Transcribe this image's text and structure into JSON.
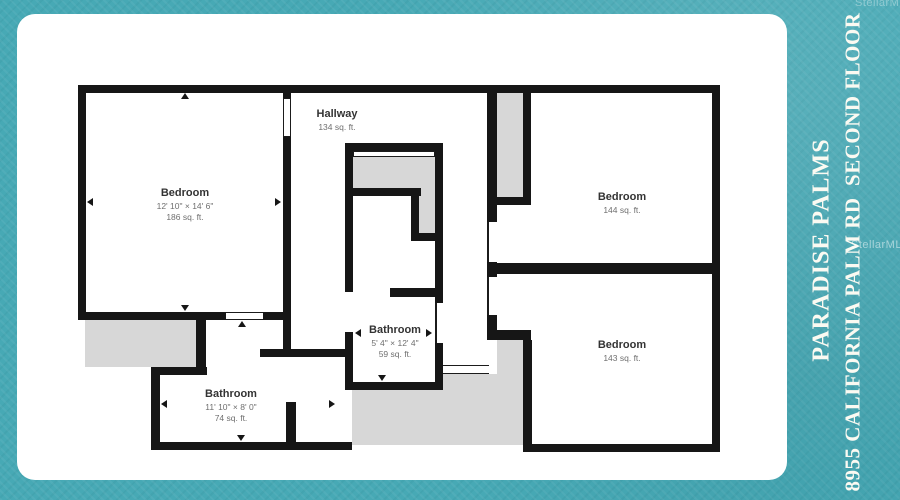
{
  "title_panel": {
    "line1": "PARADISE PALMS",
    "line2": "8955 CALIFORNIA PALM RD  SECOND FLOOR"
  },
  "watermark": "StellarMLS",
  "floorplan": {
    "rooms": [
      {
        "id": "bedroom-left",
        "name": "Bedroom",
        "dims": "12' 10\" × 14' 6\"",
        "area": "186 sq. ft."
      },
      {
        "id": "hallway",
        "name": "Hallway",
        "area": "134 sq. ft."
      },
      {
        "id": "bedroom-top-right",
        "name": "Bedroom",
        "area": "144 sq. ft."
      },
      {
        "id": "bathroom-center",
        "name": "Bathroom",
        "dims": "5' 4\" × 12' 4\"",
        "area": "59 sq. ft."
      },
      {
        "id": "bathroom-bottom",
        "name": "Bathroom",
        "dims": "11' 10\" × 8' 0\"",
        "area": "74 sq. ft."
      },
      {
        "id": "bedroom-bottom-right",
        "name": "Bedroom",
        "area": "143 sq. ft."
      }
    ]
  },
  "colors": {
    "background_teal": "#47a9b5",
    "card_white": "#ffffff",
    "wall_black": "#161616",
    "void_gray": "#d7d7d7",
    "title_text": "#fbfaf2"
  }
}
